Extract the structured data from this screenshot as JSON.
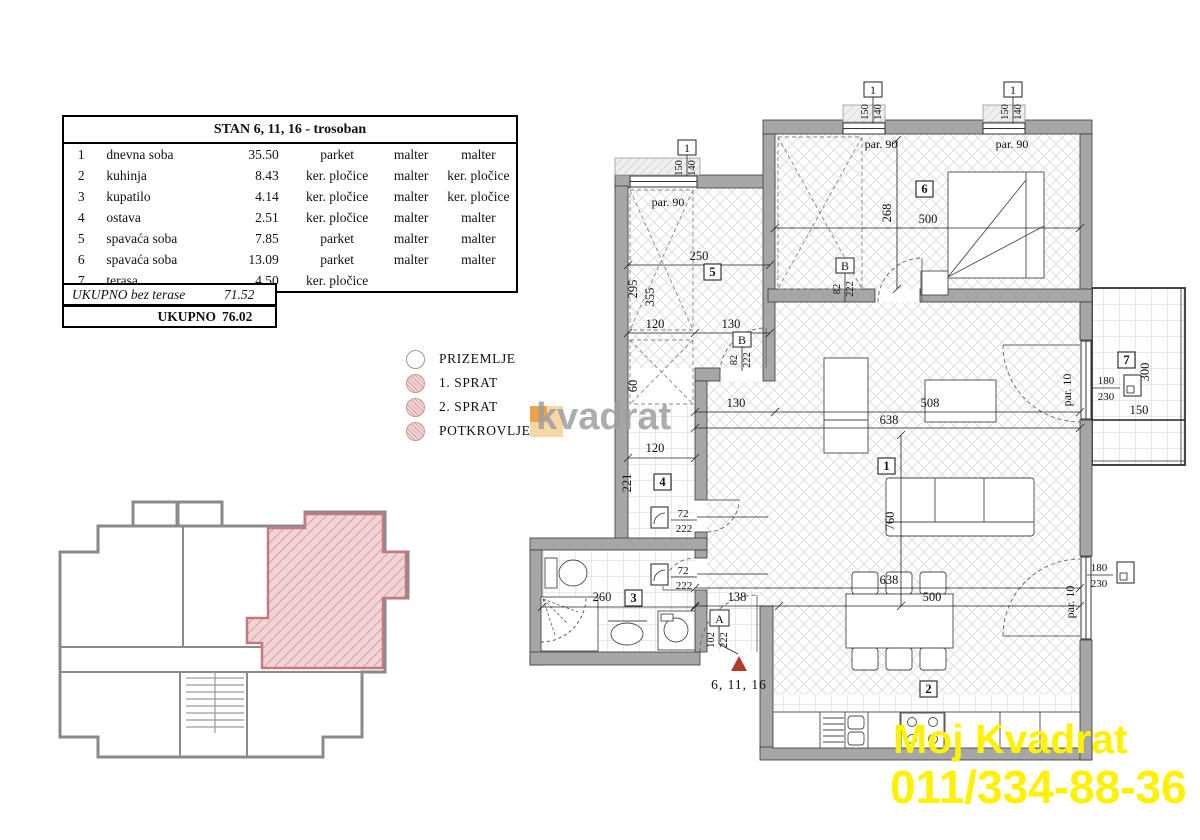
{
  "table": {
    "title": "STAN 6, 11, 16 - trosoban",
    "rows": [
      {
        "num": "1",
        "name": "dnevna soba",
        "area": "35.50",
        "floor": "parket",
        "walls": "malter",
        "ceiling": "malter"
      },
      {
        "num": "2",
        "name": "kuhinja",
        "area": "8.43",
        "floor": "ker. pločice",
        "walls": "malter",
        "ceiling": "ker. pločice"
      },
      {
        "num": "3",
        "name": "kupatilo",
        "area": "4.14",
        "floor": "ker. pločice",
        "walls": "malter",
        "ceiling": "ker. pločice"
      },
      {
        "num": "4",
        "name": "ostava",
        "area": "2.51",
        "floor": "ker. pločice",
        "walls": "malter",
        "ceiling": "malter"
      },
      {
        "num": "5",
        "name": "spavaća soba",
        "area": "7.85",
        "floor": "parket",
        "walls": "malter",
        "ceiling": "malter"
      },
      {
        "num": "6",
        "name": "spavaća soba",
        "area": "13.09",
        "floor": "parket",
        "walls": "malter",
        "ceiling": "malter"
      },
      {
        "num": "7",
        "name": "terasa",
        "area": "4.50",
        "floor": "ker. pločice",
        "walls": "",
        "ceiling": ""
      }
    ],
    "subtotal_label": "UKUPNO bez terase",
    "subtotal_value": "71.52",
    "total_label": "UKUPNO",
    "total_value": "76.02"
  },
  "legend": {
    "items": [
      {
        "label": "PRIZEMLJE"
      },
      {
        "label": "1. SPRAT"
      },
      {
        "label": "2. SPRAT"
      },
      {
        "label": "POTKROVLJE"
      }
    ]
  },
  "watermarks": {
    "logo_text": "kvadrat",
    "agency_name": "Moj Kvadrat",
    "agency_phone": "011/334-88-36"
  },
  "plan": {
    "room_numbers": [
      "1",
      "2",
      "3",
      "4",
      "5",
      "6",
      "7"
    ],
    "window": {
      "num": "1",
      "w": "150",
      "h": "140"
    },
    "door_A": {
      "letter": "A",
      "w": "102",
      "h": "222"
    },
    "door_B": {
      "letter": "B",
      "w": "82",
      "h": "222"
    },
    "door_interior": {
      "w": "72",
      "h": "222"
    },
    "door_balcony": {
      "w": "180",
      "h": "230"
    },
    "par90": "par. 90",
    "par10": "par. 10",
    "dims": {
      "d268": "268",
      "d500_top": "500",
      "d250": "250",
      "d295": "295",
      "d355": "355",
      "d120_hall": "120",
      "d130_hall": "130",
      "d60": "60",
      "d130_living": "130",
      "d638_top": "638",
      "d508": "508",
      "d120_storage": "120",
      "d221": "221",
      "d760": "760",
      "d638_bottom": "638",
      "d500_bottom": "500",
      "d138": "138",
      "d260": "260",
      "d300": "300",
      "d150": "150"
    },
    "marker_units": "6, 11, 16"
  },
  "colors": {
    "apartment_highlight": "#f2d4d6",
    "hatch_line": "#cf9198",
    "marker_red": "#b03a2e",
    "watermark_yellow": "#fef200",
    "logo_orange": "#f0a24b",
    "wall_gray": "#a6a6a6"
  }
}
